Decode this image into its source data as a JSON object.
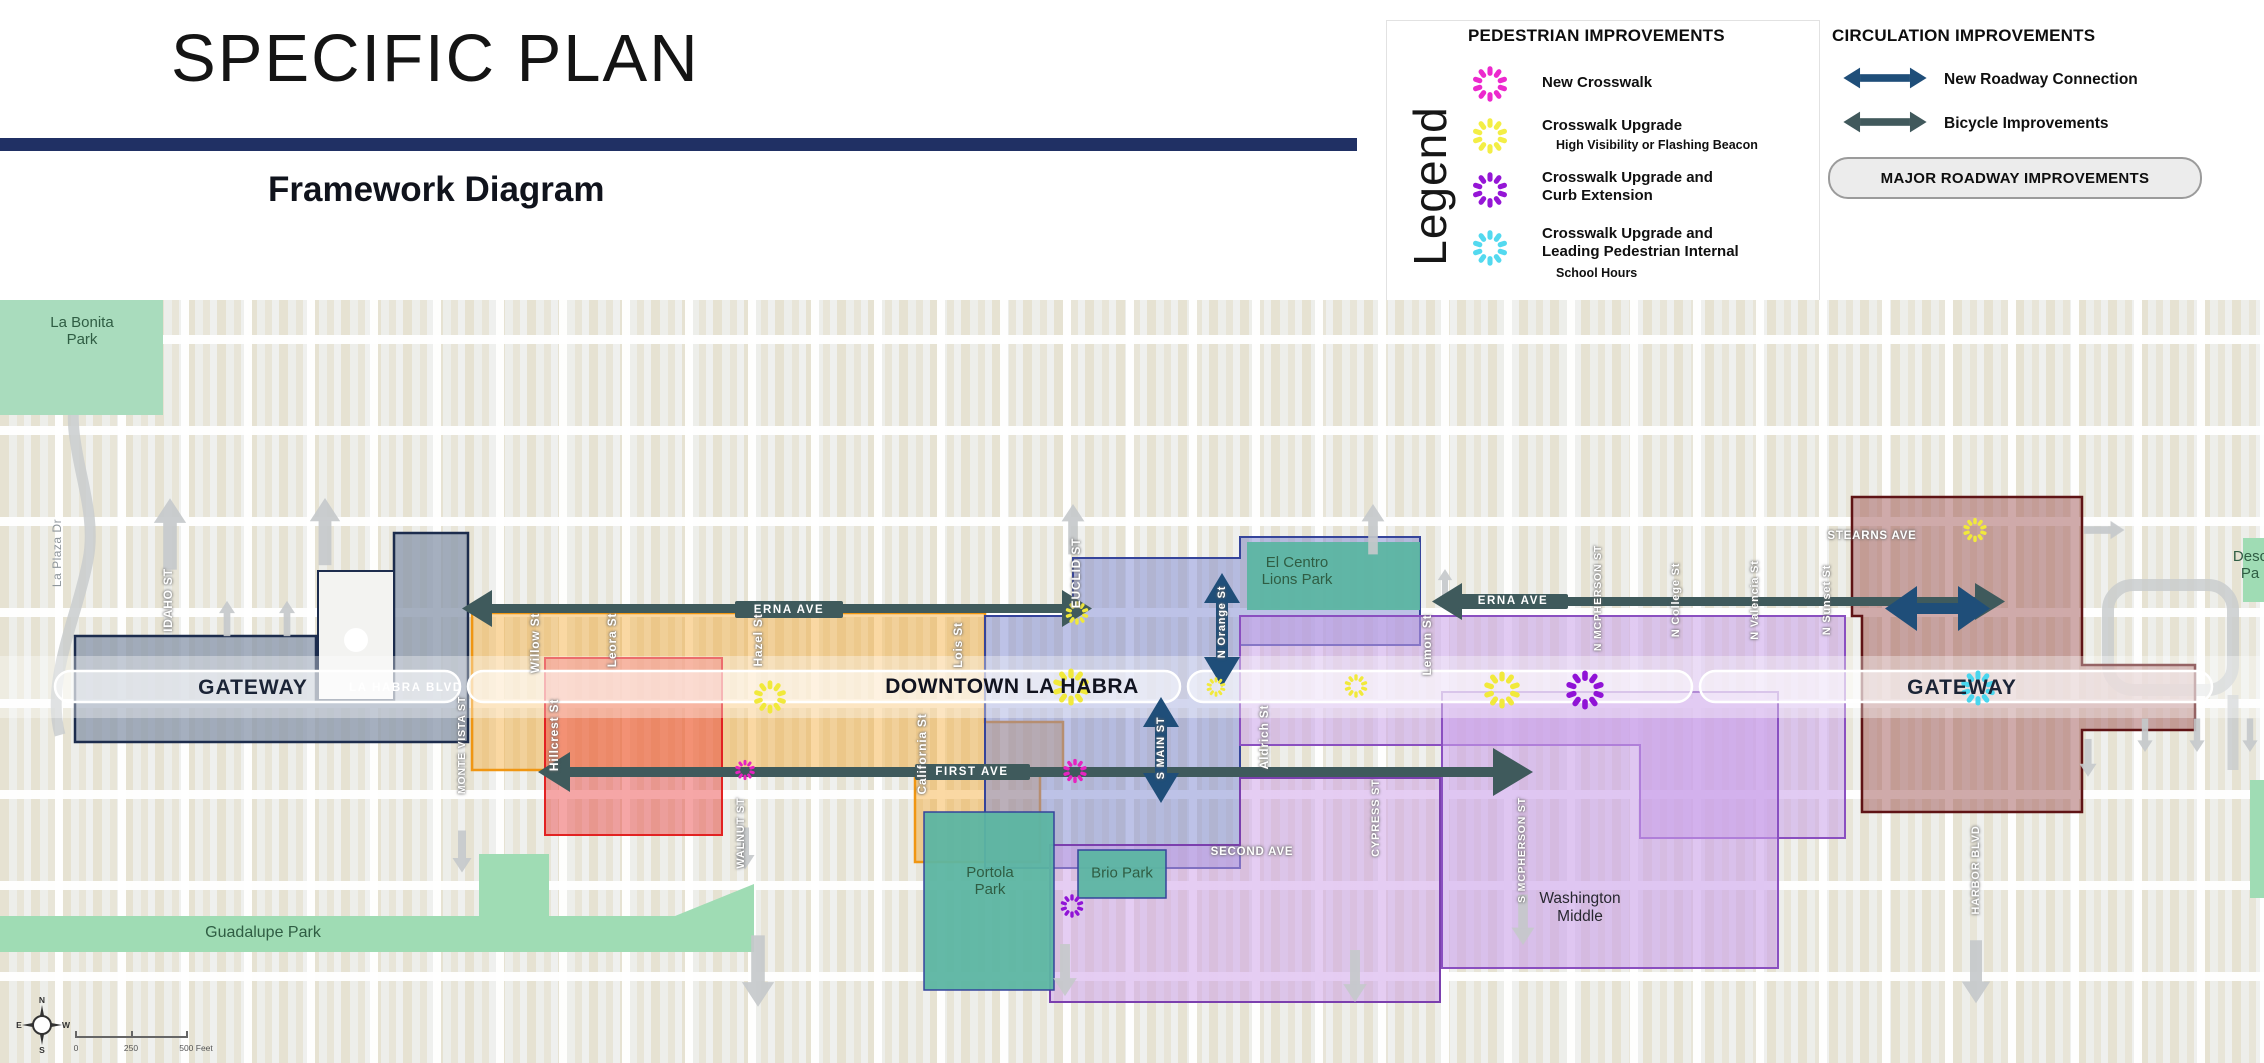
{
  "header": {
    "title": "SPECIFIC PLAN",
    "subtitle": "Framework Diagram"
  },
  "legend": {
    "title": "Legend",
    "pedestrian": {
      "heading": "PEDESTRIAN IMPROVEMENTS",
      "items": [
        {
          "label": "New Crosswalk",
          "color": "#ec29cd"
        },
        {
          "label": "Crosswalk Upgrade",
          "sublabel": "High Visibility or Flashing Beacon",
          "color": "#f3ee45"
        },
        {
          "label": "Crosswalk Upgrade and",
          "label2": "Curb Extension",
          "color": "#9516d6"
        },
        {
          "label": "Crosswalk Upgrade and",
          "label2": "Leading Pedestrian Internal",
          "sublabel": "School Hours",
          "color": "#53d9ef"
        }
      ]
    },
    "circulation": {
      "heading": "CIRCULATION IMPROVEMENTS",
      "items": [
        {
          "label": "New Roadway Connection",
          "color": "#1f4e79"
        },
        {
          "label": "Bicycle Improvements",
          "color": "#41595c"
        }
      ],
      "button": "MAJOR ROADWAY IMPROVEMENTS"
    }
  },
  "districts": [
    {
      "line1": "IDAHO ST",
      "line2": "RESIDENTIAL",
      "color": "#16283f"
    },
    {
      "line1": "VILLAGE",
      "line2": "SQUARE",
      "color": "#e8191f"
    },
    {
      "line1": "COMMERCIAL",
      "line2": "CORE",
      "color": "#f6a21d"
    },
    {
      "line1": "CULTURAL",
      "line2": "CORE",
      "color": "#6672c4"
    },
    {
      "line1": "WASHINGTON",
      "line2": "MIDDLE",
      "color": "#b46ee9"
    },
    {
      "line1": "HARBOR",
      "line2": "GATEWAY",
      "color": "#7b181b"
    }
  ],
  "colors": {
    "yellow": "#f1e93b",
    "magenta": "#e623c0",
    "purple": "#9013d6",
    "cyan": "#49d6ee",
    "new_roadway": "#1f4e79",
    "bicycle": "#3f5a5c",
    "major_roadway": "#c6c9cb"
  },
  "map": {
    "callouts": {
      "gateway": "GATEWAY",
      "downtown": "DOWNTOWN LA HABRA"
    },
    "streets": {
      "la_habra": "LA HABRA BLVD",
      "erna": "ERNA AVE",
      "first": "FIRST AVE",
      "second": "SECOND AVE",
      "stearns": "STEARNS AVE",
      "monte_vista": "MONTE VISTA ST",
      "willow": "Willow St",
      "leora": "Leora St",
      "hazel": "Hazel St",
      "lois": "Lois St",
      "euclid": "EUCLID ST",
      "hillcrest": "Hillcrest St",
      "california": "California St",
      "walnut": "WALNUT ST",
      "cypress": "CYPRESS ST",
      "aldrich": "Aldrich St",
      "main": "S MAIN ST",
      "orange": "N Orange St",
      "lemon": "Lemon St",
      "mcpherson_n": "N MCPHERSON ST",
      "college": "N College St",
      "valencia": "N Valencia St",
      "sunset": "N Sunset St",
      "mcpherson_s": "S MCPHERSON ST",
      "harbor": "HARBOR BLVD",
      "idaho": "IDAHO ST",
      "la_plaza": "La Plaza Dr"
    },
    "parks": {
      "la_bonita": {
        "line1": "La Bonita",
        "line2": "Park"
      },
      "guadalupe": "Guadalupe Park",
      "portola": {
        "line1": "Portola",
        "line2": "Park"
      },
      "brio": "Brio Park",
      "el_centro": {
        "line1": "El Centro",
        "line2": "Lions Park"
      },
      "desc": {
        "line1": "Desc",
        "line2": "Pa"
      }
    },
    "places": {
      "washington": {
        "line1": "Washington",
        "line2": "Middle"
      }
    },
    "compass": {
      "n": "N",
      "e": "E",
      "w": "W",
      "s": "S"
    },
    "scale": {
      "start": "0",
      "mid": "250",
      "end": "500 Feet"
    }
  }
}
